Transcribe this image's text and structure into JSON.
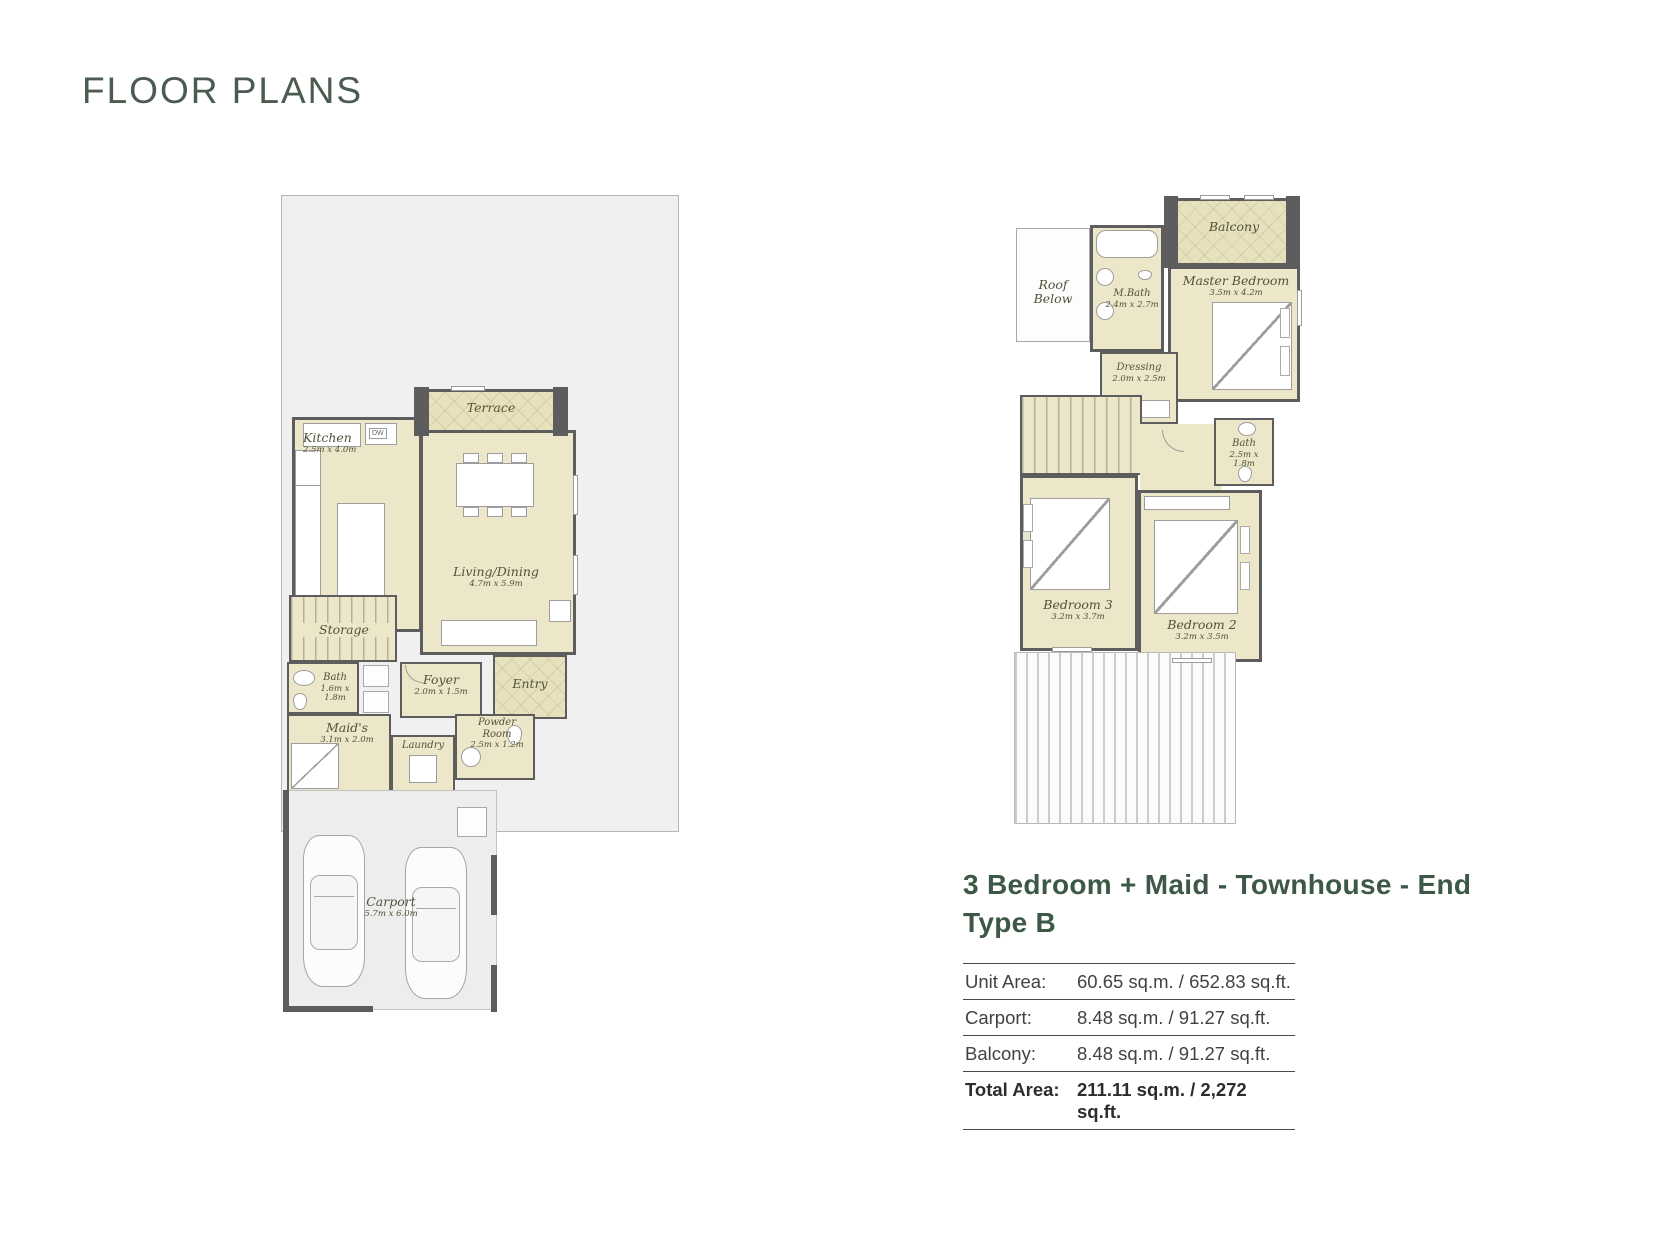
{
  "title": "FLOOR PLANS",
  "unit": {
    "heading_line1": "3 Bedroom + Maid - Townhouse - End",
    "heading_line2": "Type B",
    "area_table": {
      "rows": [
        {
          "label": "Unit Area:",
          "value": "60.65 sq.m.  / 652.83 sq.ft."
        },
        {
          "label": "Carport:",
          "value": "8.48 sq.m.  / 91.27 sq.ft."
        },
        {
          "label": "Balcony:",
          "value": "8.48 sq.m.  / 91.27 sq.ft."
        },
        {
          "label": "Total Area:",
          "value": "211.11 sq.m. / 2,272 sq.ft."
        }
      ]
    }
  },
  "ground_floor": {
    "appliance_tag": "DW",
    "rooms": {
      "terrace": {
        "name": "Terrace"
      },
      "kitchen": {
        "name": "Kitchen",
        "dims": "2.5m x 4.0m"
      },
      "living_dining": {
        "name": "Living/Dining",
        "dims": "4.7m x 5.9m"
      },
      "storage": {
        "name": "Storage"
      },
      "bath": {
        "name": "Bath",
        "dims": "1.6m x 1.8m"
      },
      "foyer": {
        "name": "Foyer",
        "dims": "2.0m x 1.5m"
      },
      "entry": {
        "name": "Entry"
      },
      "maids": {
        "name": "Maid's",
        "dims": "3.1m x 2.0m"
      },
      "powder": {
        "name": "Powder Room",
        "dims": "2.5m x 1.2m"
      },
      "laundry": {
        "name": "Laundry"
      },
      "carport": {
        "name": "Carport",
        "dims": "5.7m x 6.0m"
      }
    }
  },
  "first_floor": {
    "rooms": {
      "roof_below": {
        "name": "Roof Below"
      },
      "m_bath": {
        "name": "M.Bath",
        "dims": "2.4m x 2.7m"
      },
      "balcony": {
        "name": "Balcony"
      },
      "master_bedroom": {
        "name": "Master Bedroom",
        "dims": "3.5m x 4.2m"
      },
      "dressing": {
        "name": "Dressing",
        "dims": "2.0m x 2.5m"
      },
      "bath": {
        "name": "Bath",
        "dims": "2.5m x 1.8m"
      },
      "bedroom3": {
        "name": "Bedroom 3",
        "dims": "3.2m x 3.7m"
      },
      "bedroom2": {
        "name": "Bedroom 2",
        "dims": "3.2m x 3.5m"
      }
    }
  },
  "colors": {
    "accent_green": "#3d5846",
    "title_green": "#4c5b50",
    "room_fill": "#ece7c9",
    "wall": "#5d5d5d",
    "plot_fill": "#f0f0f1"
  }
}
